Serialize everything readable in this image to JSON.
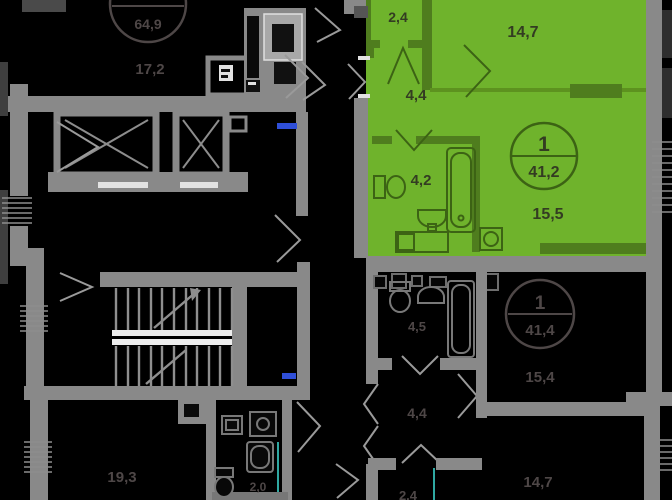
{
  "plan": {
    "type": "residential-floor-plan",
    "highlighted_apartment": "1-room 41,2 m2"
  },
  "colors": {
    "background": "#000000",
    "wall_gray": "#898989",
    "highlight_green": "#6fb32c",
    "highlight_wall_green": "#4f7d1e",
    "label_on_green": "#333c22",
    "label_dim": "#4e4747",
    "accent_teal": "#2fa8a2",
    "accent_blue": "#2f4fd8",
    "landing_white": "#ededed"
  },
  "badges": {
    "highlighted": {
      "rooms": "1",
      "area": "41,2"
    },
    "bottom": {
      "rooms": "1",
      "area": "41,4"
    },
    "top_left": {
      "area": "64,9"
    }
  },
  "rooms": {
    "highlighted": {
      "balcony": "2,4",
      "bedroom": "14,7",
      "hall": "4,4",
      "bath": "4,2",
      "living": "15,5"
    },
    "top_left": {
      "room": "17,2"
    },
    "bottom_left": {
      "room": "19,3",
      "wc": "2,0"
    },
    "bottom": {
      "bath": "4,5",
      "hall": "4,4",
      "living": "15,4",
      "bedroom": "14,7",
      "balcony": "2,4"
    }
  }
}
